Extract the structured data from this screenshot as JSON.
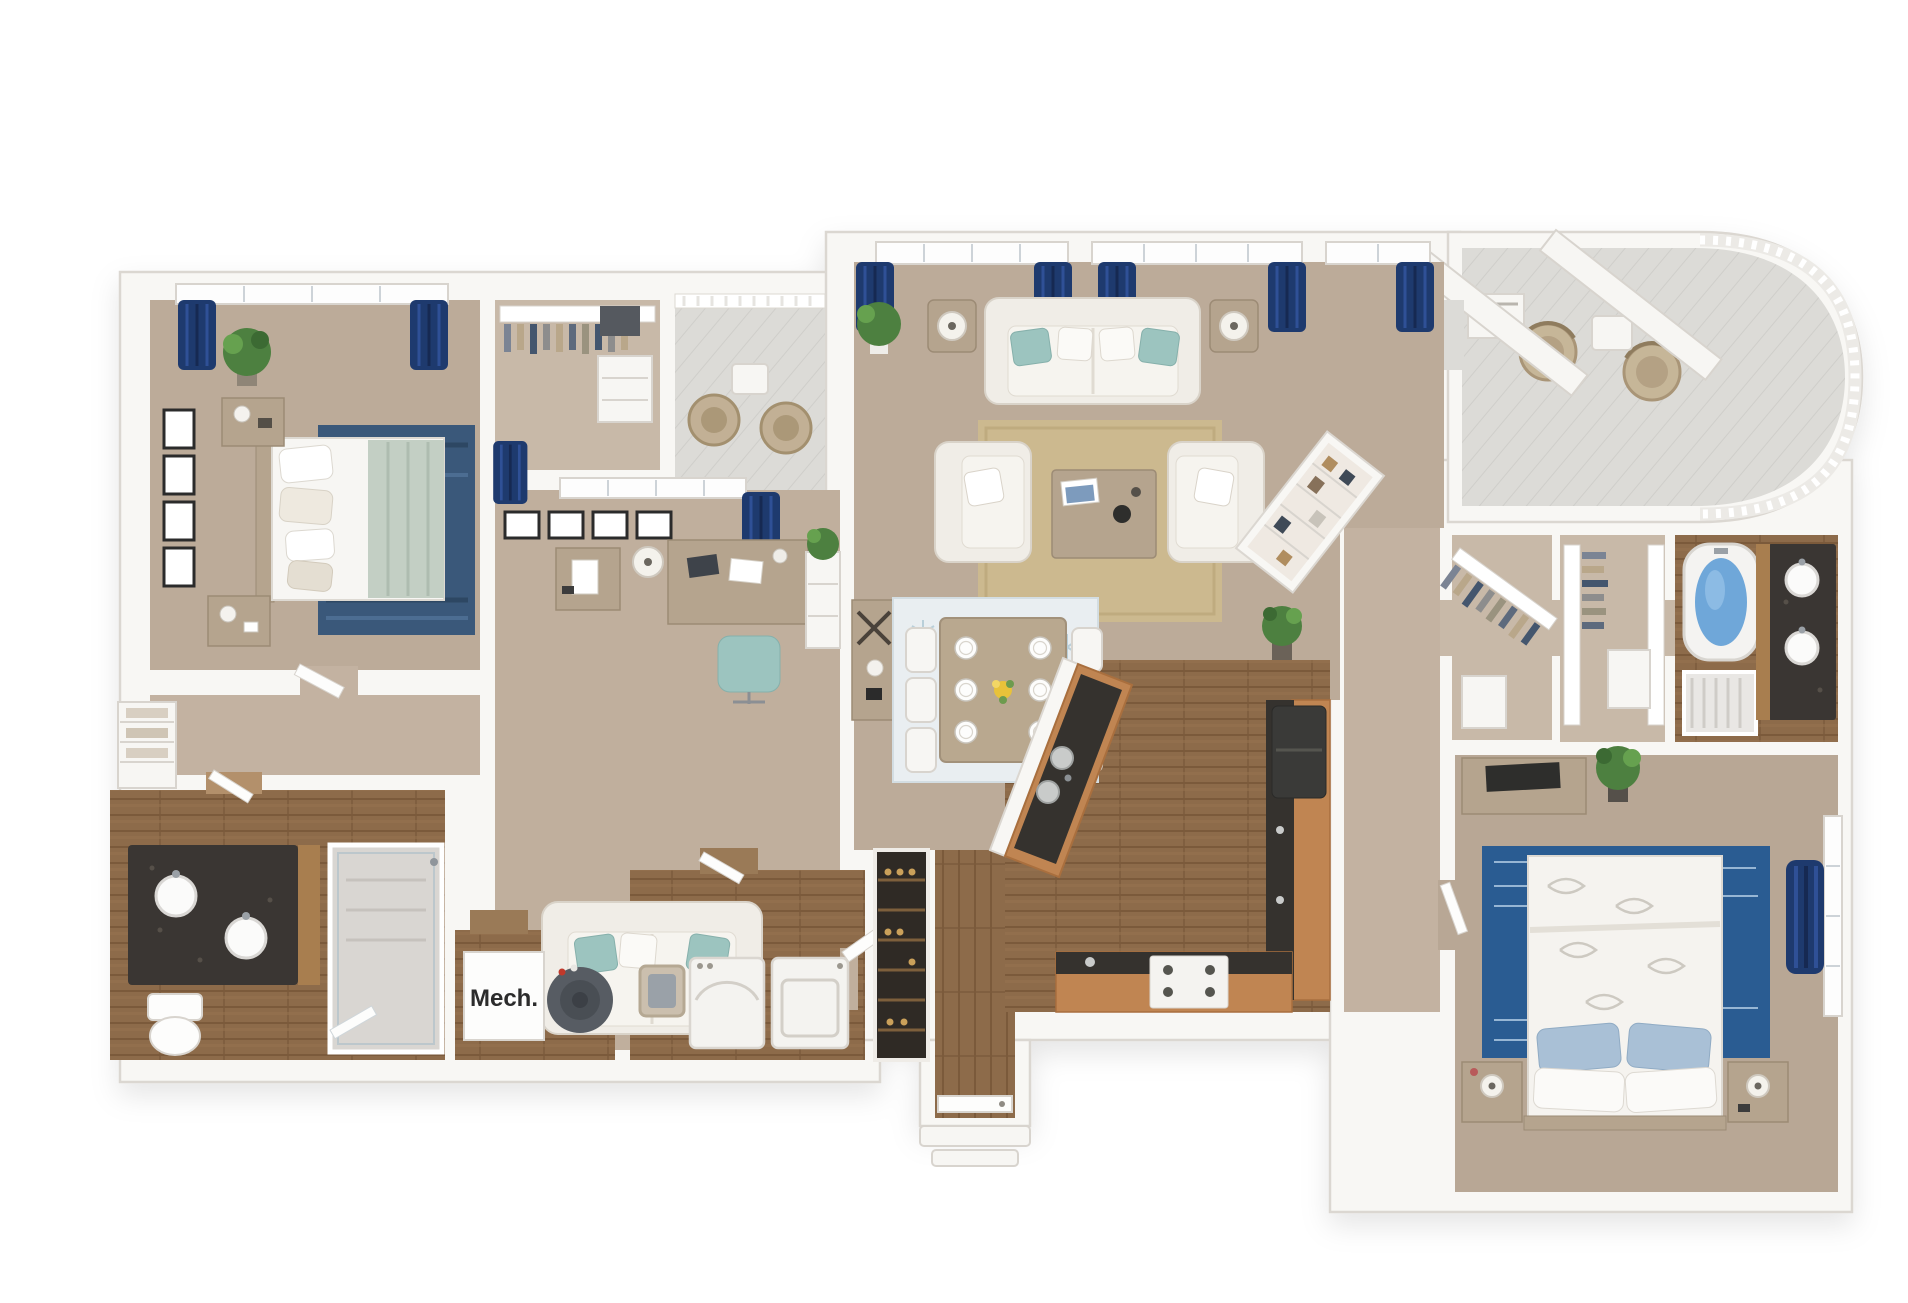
{
  "page": {
    "kind": "3d-floor-plan-rendering",
    "background": "#ffffff"
  },
  "labels": {
    "mech_room": "Mech."
  },
  "palette": {
    "wall": "#f8f7f4",
    "wall_edge": "#dbd7d1",
    "carpet_main": "#bcab99",
    "carpet_light": "#c8b9a8",
    "carpet_office": "#c0af9d",
    "carpet_hall": "#c3b2a1",
    "carpet_bedroom2": "#b8a795",
    "wood_floor": "#8d6b4a",
    "wood_plank_line": "#7b5a3b",
    "deck": "#dcdbd7",
    "curtain_navy": "#1e3a6e",
    "rug_navy_bedroom1": "#3a587a",
    "rug_denim_bedroom2": "#2a5c92",
    "rug_tan_living": "#ccb98f",
    "rug_dining": "#e9eef1",
    "sofa_white": "#f0ede7",
    "pillow_teal": "#9cc4bf",
    "furniture_taupe": "#b5a48e",
    "cabinet_wood": "#c08552",
    "counter_dark": "#35322e",
    "granite": "#3a3633",
    "appliance_white": "#f4f3f0",
    "fridge_dark": "#3a3a38",
    "tub_water": "#6fa7d9",
    "plant_green": "#4d8040",
    "water_heater": "#575c63"
  },
  "scene": {
    "rooms": [
      {
        "id": "bedroom-1",
        "furniture": [
          "bed",
          "nightstand",
          "nightstand",
          "navy-rug",
          "plant",
          "wall-art-x4",
          "window-navy-curtains"
        ]
      },
      {
        "id": "walk-in-closet-1",
        "furniture": [
          "clothes-rack",
          "dresser",
          "storage-box"
        ]
      },
      {
        "id": "balcony-1",
        "furniture": [
          "patio-chair",
          "patio-chair",
          "side-table",
          "railing"
        ]
      },
      {
        "id": "office-den",
        "furniture": [
          "desk",
          "teal-desk-chair",
          "loveseat",
          "side-cabinet",
          "floor-lamp",
          "bookshelf-with-plant",
          "wall-art-x4",
          "window-navy-curtains"
        ]
      },
      {
        "id": "hallway-left",
        "furniture": [
          "linen-shelves"
        ]
      },
      {
        "id": "bathroom-1",
        "furniture": [
          "double-vanity",
          "sink",
          "sink",
          "toilet",
          "shower"
        ]
      },
      {
        "id": "mech-room",
        "label": "Mech.",
        "furniture": [
          "water-heater"
        ]
      },
      {
        "id": "laundry-room",
        "furniture": [
          "washer",
          "dryer",
          "laundry-basket"
        ]
      },
      {
        "id": "wine-pantry-rack",
        "furniture": [
          "shelving"
        ]
      },
      {
        "id": "entry",
        "furniture": [
          "front-door",
          "steps"
        ]
      },
      {
        "id": "living-room",
        "furniture": [
          "sofa",
          "armchair",
          "armchair",
          "coffee-table",
          "side-table-lamp",
          "side-table-lamp",
          "tan-rug",
          "plant",
          "plant",
          "window-navy-curtains-x5"
        ]
      },
      {
        "id": "dining-area",
        "furniture": [
          "dining-table",
          "chairs-x6",
          "place-settings-x6",
          "flower-centerpiece",
          "pale-blue-rug"
        ]
      },
      {
        "id": "kitchen",
        "furniture": [
          "angled-island-with-sink",
          "refrigerator",
          "range",
          "counters",
          "wood-cabinets"
        ]
      },
      {
        "id": "pantry-corner-shelf",
        "furniture": [
          "shelving"
        ]
      },
      {
        "id": "hallway-right",
        "furniture": []
      },
      {
        "id": "walk-in-closet-2",
        "furniture": [
          "angled-clothes-rack"
        ]
      },
      {
        "id": "walk-in-closet-3",
        "furniture": [
          "clothes-rack",
          "clothes-rack",
          "storage-box"
        ]
      },
      {
        "id": "bathroom-2",
        "furniture": [
          "garden-tub",
          "shower",
          "double-vanity",
          "sinks-x2"
        ]
      },
      {
        "id": "bedroom-2",
        "furniture": [
          "bed-leaf-duvet",
          "nightstand-lamp",
          "nightstand-lamp",
          "denim-rug",
          "dresser-tv",
          "plant",
          "window-navy-curtain"
        ]
      },
      {
        "id": "balcony-2",
        "furniture": [
          "wicker-chair",
          "wicker-chair",
          "side-table",
          "curved-railing",
          "roof-beams",
          "utility-box"
        ]
      }
    ]
  }
}
